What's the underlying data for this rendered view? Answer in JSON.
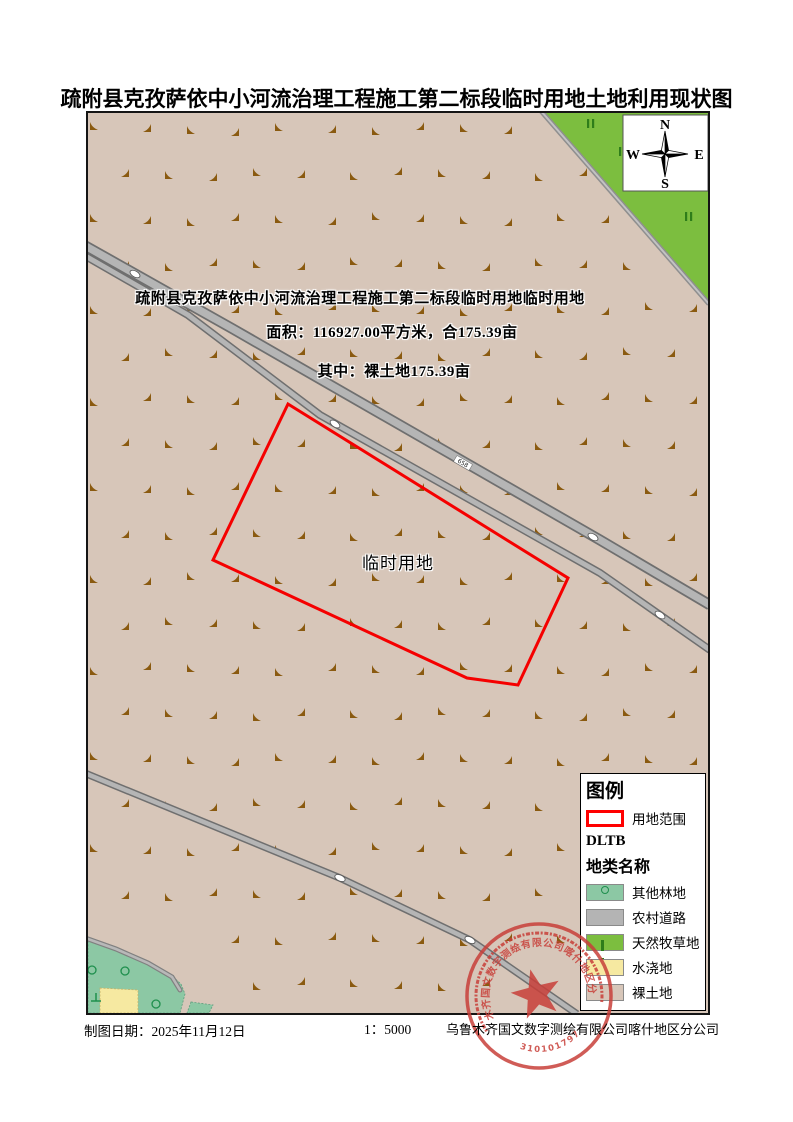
{
  "title": "疏附县克孜萨依中小河流治理工程施工第二标段临时用地土地利用现状图",
  "annotations": {
    "line1": "疏附县克孜萨依中小河流治理工程施工第二标段临时用地临时用地",
    "line2": "面积：116927.00平方米，合175.39亩",
    "line3": "其中：裸土地175.39亩",
    "parcel_label": "临时用地"
  },
  "compass": {
    "n": "N",
    "s": "S",
    "e": "E",
    "w": "W"
  },
  "legend": {
    "heading": "图例",
    "boundary_label": "用地范围",
    "dltb": "DLTB",
    "subheading": "地类名称",
    "boundary_color": "#FF0000",
    "items": [
      {
        "label": "其他林地",
        "color": "#8CC8A4"
      },
      {
        "label": "农村道路",
        "color": "#B4B4B4"
      },
      {
        "label": "天然牧草地",
        "color": "#7CBE3F"
      },
      {
        "label": "水浇地",
        "color": "#F6E9A1"
      },
      {
        "label": "裸土地",
        "color": "#D7C6B9"
      }
    ]
  },
  "road_marker": "658",
  "footer": {
    "date_label": "制图日期：2025年11月12日",
    "scale": "1：5000",
    "company": "乌鲁木齐国文数字测绘有限公司喀什地区分公司"
  },
  "stamp": {
    "company_arc": "乌鲁木齐国文数字测绘有限公司喀什地区分公司",
    "number": "6531010179783",
    "color": "#C8403A"
  },
  "colors": {
    "bare_soil": "#D7C6B9",
    "pasture": "#7CBE3F",
    "forest": "#8CC8A4",
    "irrigated": "#F6E9A1",
    "road_fill": "#B5B5B5",
    "road_casing": "#6F6F6F",
    "grass": "#8A5A10",
    "parcel_red": "#F50000"
  }
}
